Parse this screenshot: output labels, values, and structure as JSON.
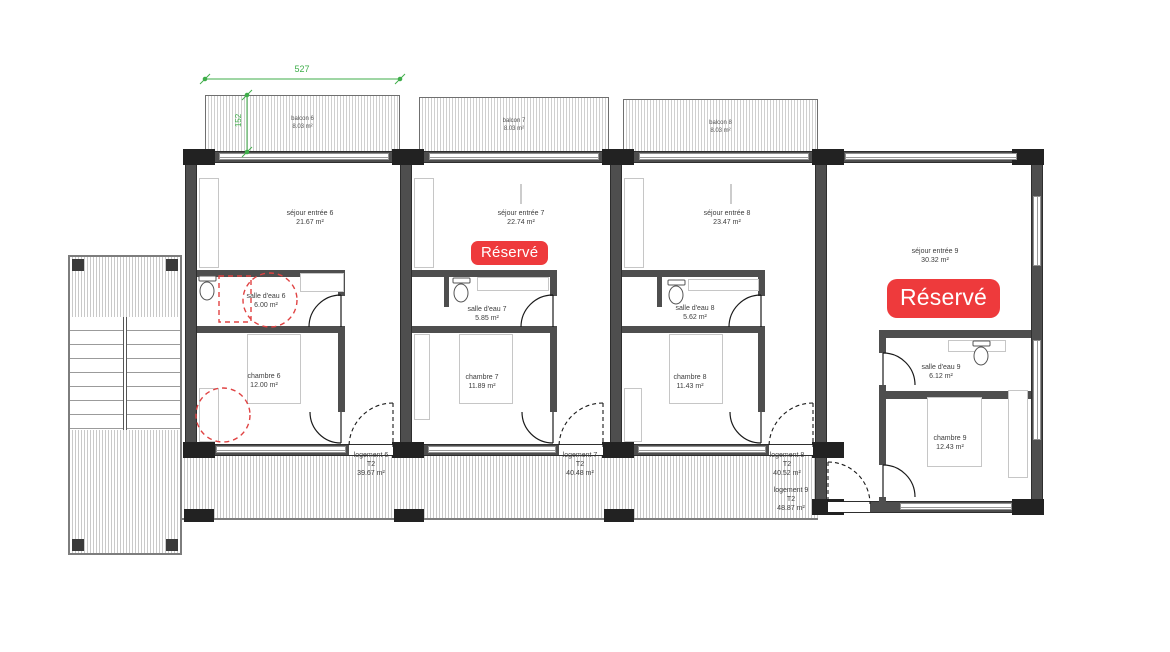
{
  "plan": {
    "dimension_width": "527",
    "dimension_height": "152",
    "reserved_label": "Réservé",
    "colors": {
      "reserved_red": "#ee3a3c",
      "dimension_green": "#3fae4a",
      "accessibility_red": "#e04343",
      "wall_gray": "#4e4e4e"
    },
    "balconies": [
      {
        "label": "balcon 6",
        "area": "8.03 m²"
      },
      {
        "label": "balcon 7",
        "area": "8.03 m²"
      },
      {
        "label": "balcon 8",
        "area": "8.03 m²"
      }
    ],
    "units": [
      {
        "label": "logement 6",
        "type": "T2",
        "area": "39.67 m²",
        "reserved": false,
        "rooms": {
          "sejour": {
            "label": "séjour entrée 6",
            "area": "21.67 m²"
          },
          "salle_eau": {
            "label": "salle d'eau 6",
            "area": "6.00 m²"
          },
          "chambre": {
            "label": "chambre 6",
            "area": "12.00 m²"
          }
        }
      },
      {
        "label": "logement 7",
        "type": "T2",
        "area": "40.48 m²",
        "reserved": true,
        "rooms": {
          "sejour": {
            "label": "séjour entrée 7",
            "area": "22.74 m²"
          },
          "salle_eau": {
            "label": "salle d'eau 7",
            "area": "5.85 m²"
          },
          "chambre": {
            "label": "chambre 7",
            "area": "11.89 m²"
          }
        }
      },
      {
        "label": "logement 8",
        "type": "T2",
        "area": "40.52 m²",
        "reserved": false,
        "rooms": {
          "sejour": {
            "label": "séjour entrée 8",
            "area": "23.47 m²"
          },
          "salle_eau": {
            "label": "salle d'eau 8",
            "area": "5.62 m²"
          },
          "chambre": {
            "label": "chambre 8",
            "area": "11.43 m²"
          }
        }
      },
      {
        "label": "logement 9",
        "type": "T2",
        "area": "48.87 m²",
        "reserved": true,
        "rooms": {
          "sejour": {
            "label": "séjour entrée 9",
            "area": "30.32 m²"
          },
          "salle_eau": {
            "label": "salle d'eau 9",
            "area": "6.12 m²"
          },
          "chambre": {
            "label": "chambre 9",
            "area": "12.43 m²"
          }
        }
      }
    ]
  }
}
